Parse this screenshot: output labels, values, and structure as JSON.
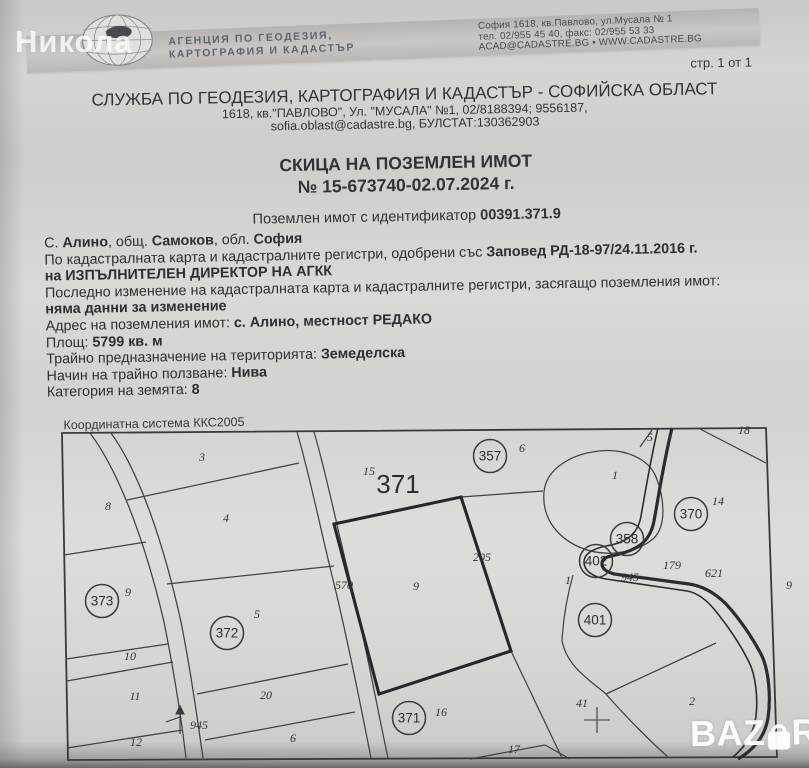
{
  "watermarks": {
    "photographer": "Никола",
    "listing_site_left": "BAZ",
    "listing_site_right": "R"
  },
  "banner": {
    "agency_line1": "АГЕНЦИЯ ПО ГЕОДЕЗИЯ,",
    "agency_line2": "КАРТОГРАФИЯ И КАДАСТЪР",
    "address_line1": "София 1618, кв.Павлово, ул.Мусала № 1",
    "address_line2": "тел. 02/955 45 40, факс: 02/955 53 33",
    "address_line3": "ACAD@CADASTRE.BG • WWW.CADASTRE.BG"
  },
  "page_number": "стр. 1 от 1",
  "office": {
    "title": "СЛУЖБА ПО ГЕОДЕЗИЯ, КАРТОГРАФИЯ И КАДАСТЪР - СОФИЙСКА ОБЛАСТ",
    "address": "1618, кв.\"ПАВЛОВО\", Ул. \"МУСАЛА\" №1, 02/8188394; 9556187,",
    "contact": "sofia.oblast@cadastre.bg, БУЛСТАТ:130362903"
  },
  "doc_title": {
    "line1": "СКИЦА НА ПОЗЕМЛЕН ИМОТ",
    "line2": "№ 15-673740-02.07.2024 г."
  },
  "identifier": {
    "label": "Поземлен имот с идентификатор",
    "value": "00391.371.9"
  },
  "details": {
    "lines": [
      [
        [
          "С. ",
          0
        ],
        [
          "Алино",
          1
        ],
        [
          ", общ. ",
          0
        ],
        [
          "Самоков",
          1
        ],
        [
          ", обл. ",
          0
        ],
        [
          "София",
          1
        ]
      ],
      [
        [
          "По кадастралната карта и кадастралните регистри, одобрени със ",
          0
        ],
        [
          "Заповед РД-18-97/24.11.2016 г.",
          1
        ]
      ],
      [
        [
          "на ИЗПЪЛНИТЕЛЕН ДИРЕКТОР НА АГКК",
          1
        ]
      ],
      [
        [
          "Последно изменение на кадастралната карта и кадастралните регистри, засягащо поземления имот:",
          0
        ]
      ],
      [
        [
          "няма данни за изменение",
          1
        ]
      ],
      [
        [
          "Адрес на поземления имот: ",
          0
        ],
        [
          "с. Алино, местност РЕДАКО",
          1
        ]
      ],
      [
        [
          "Площ: ",
          0
        ],
        [
          "5799 кв. м",
          1
        ]
      ],
      [
        [
          "Трайно предназначение на територията: ",
          0
        ],
        [
          "Земеделска",
          1
        ]
      ],
      [
        [
          "Начин на трайно ползване: ",
          0
        ],
        [
          "Нива",
          1
        ]
      ],
      [
        [
          "Категория на земята: ",
          0
        ],
        [
          "8",
          1
        ]
      ]
    ]
  },
  "map": {
    "coord_system": "Координатна система ККС2005",
    "region_number": {
      "t": "371",
      "x": 398,
      "y": 493
    },
    "labels": [
      {
        "t": "3",
        "x": 202,
        "y": 461
      },
      {
        "t": "8",
        "x": 108,
        "y": 510
      },
      {
        "t": "4",
        "x": 226,
        "y": 522
      },
      {
        "t": "9",
        "x": 128,
        "y": 596
      },
      {
        "t": "10",
        "x": 130,
        "y": 660
      },
      {
        "t": "11",
        "x": 135,
        "y": 700
      },
      {
        "t": "12",
        "x": 136,
        "y": 746
      },
      {
        "t": "5",
        "x": 257,
        "y": 618
      },
      {
        "t": "20",
        "x": 266,
        "y": 699
      },
      {
        "t": "6",
        "x": 293,
        "y": 742
      },
      {
        "t": "15",
        "x": 369,
        "y": 475
      },
      {
        "t": "9",
        "x": 416,
        "y": 590
      },
      {
        "t": "205",
        "x": 482,
        "y": 561
      },
      {
        "t": "570",
        "x": 344,
        "y": 589
      },
      {
        "t": "16",
        "x": 441,
        "y": 716
      },
      {
        "t": "17",
        "x": 514,
        "y": 753
      },
      {
        "t": "6",
        "x": 522,
        "y": 452
      },
      {
        "t": "5",
        "x": 650,
        "y": 441
      },
      {
        "t": "1",
        "x": 615,
        "y": 479
      },
      {
        "t": "18",
        "x": 744,
        "y": 434
      },
      {
        "t": "14",
        "x": 718,
        "y": 505
      },
      {
        "t": "1",
        "x": 568,
        "y": 584
      },
      {
        "t": "945",
        "x": 630,
        "y": 581
      },
      {
        "t": "179",
        "x": 672,
        "y": 569
      },
      {
        "t": "621",
        "x": 714,
        "y": 577
      },
      {
        "t": "9",
        "x": 789,
        "y": 589
      },
      {
        "t": "41",
        "x": 582,
        "y": 707
      },
      {
        "t": "2",
        "x": 692,
        "y": 705
      },
      {
        "t": "945",
        "x": 199,
        "y": 729
      }
    ],
    "circles": [
      {
        "t": "373",
        "x": 102,
        "y": 601
      },
      {
        "t": "372",
        "x": 227,
        "y": 633
      },
      {
        "t": "357",
        "x": 490,
        "y": 456
      },
      {
        "t": "358",
        "x": 627,
        "y": 539
      },
      {
        "t": "402",
        "x": 596,
        "y": 561
      },
      {
        "t": "370",
        "x": 691,
        "y": 514
      },
      {
        "t": "401",
        "x": 595,
        "y": 620
      },
      {
        "t": "371",
        "x": 409,
        "y": 718
      }
    ]
  }
}
